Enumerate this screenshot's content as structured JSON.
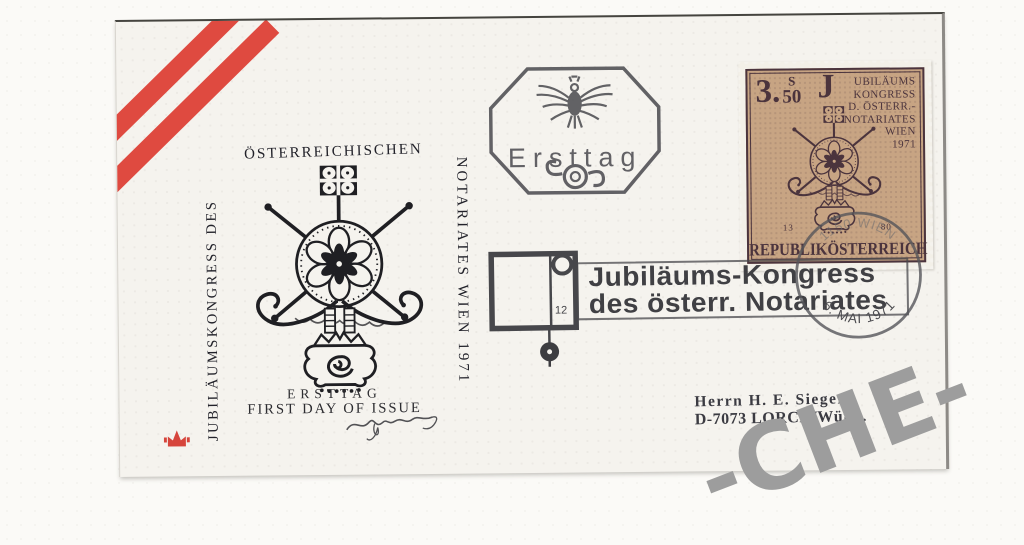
{
  "cachet": {
    "arc_top": "ÖSTERREICHISCHEN",
    "left_vertical": "JUBILÄUMSKONGRESS DES",
    "right_vertical": "NOTARIATES WIEN 1971",
    "ersttag": "ERSTTAG",
    "first_day": "FIRST DAY OF ISSUE"
  },
  "octagon_postmark": {
    "label": "Ersttag"
  },
  "machine_cancel": {
    "slogan_line1": "Jubiläums-Kongress",
    "slogan_line2": "des österr. Notariates",
    "doc_number": "12",
    "city_arc": "1150 WIEN",
    "date": "6. MAI 1971"
  },
  "stamp": {
    "value": "3.",
    "currency": "S",
    "value_minor": "50",
    "initial": "J",
    "lines": [
      "UBILÄUMS",
      "KONGRESS",
      "D. ÖSTERR.-",
      "NOTARIATES",
      "WIEN",
      "1971"
    ],
    "num_left": "13",
    "num_right": "80",
    "country": "REPUBLIKÖSTERREICH"
  },
  "address": {
    "line1": "Herrn H. E. Sieger",
    "line2": "D-7073 LORCH/Württ."
  },
  "watermark": "-CHE-",
  "colors": {
    "stripe_red": "#df4a40",
    "stamp_paper": "#c7a483",
    "stamp_ink": "#4b343d",
    "cachet_ink": "#22222a",
    "cancel_ink": "#47474b",
    "watermark_gray": "#9d9d9d",
    "envelope_paper": "#f5f3ee"
  }
}
